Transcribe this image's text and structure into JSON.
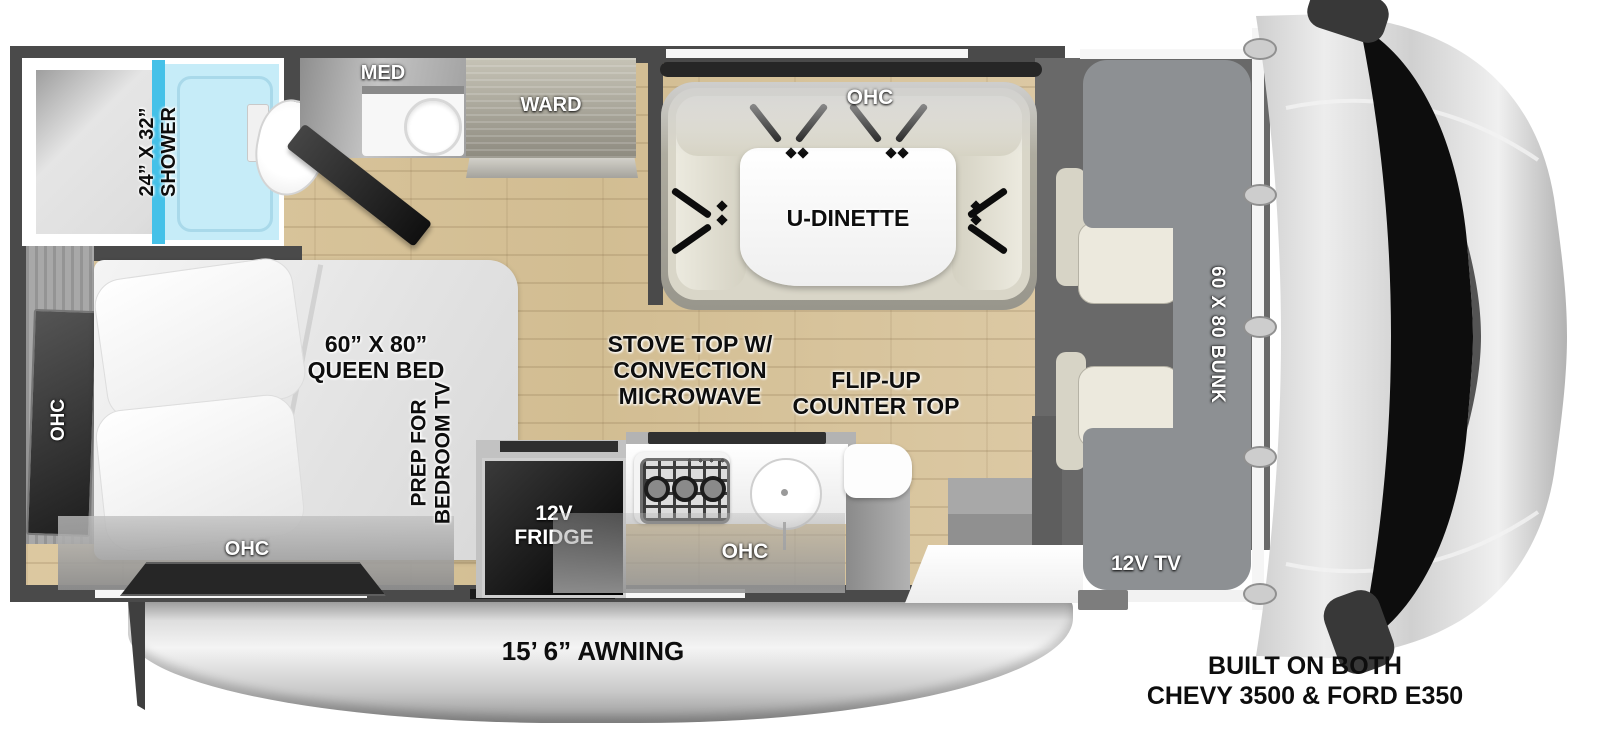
{
  "diagram": {
    "kind": "RV floor plan",
    "labels": {
      "shower_size": "24” X 32”",
      "shower": "SHOWER",
      "med": "MED",
      "ward": "WARD",
      "ohc": "OHC",
      "u_dinette": "U-DINETTE",
      "bed_size": "60” X 80”",
      "bed": "QUEEN BED",
      "prep_tv_1": "PREP FOR",
      "prep_tv_2": "BEDROOM TV",
      "stove_1": "STOVE TOP W/",
      "stove_2": "CONVECTION",
      "stove_3": "MICROWAVE",
      "flip_1": "FLIP-UP",
      "flip_2": "COUNTER TOP",
      "fridge_1": "12V",
      "fridge_2": "FRIDGE",
      "bunk": "60 X 80 BUNK",
      "tv": "12V TV",
      "awning": "15’ 6” AWNING",
      "footer_1": "BUILT ON BOTH",
      "footer_2": "CHEVY 3500 & FORD E350"
    },
    "colors": {
      "wall": "#4a4a4a",
      "floor_wood": "#d8c49c",
      "shower_glass_blue": "#45c1e8",
      "shower_pan_blue": "#c6ecf8",
      "bunk_gray": "#8d9093",
      "seat_beige": "#e3e0d2",
      "awning_gray": "#c6c6c6",
      "label_black": "#0d0d0d",
      "label_white": "#ffffff"
    }
  }
}
